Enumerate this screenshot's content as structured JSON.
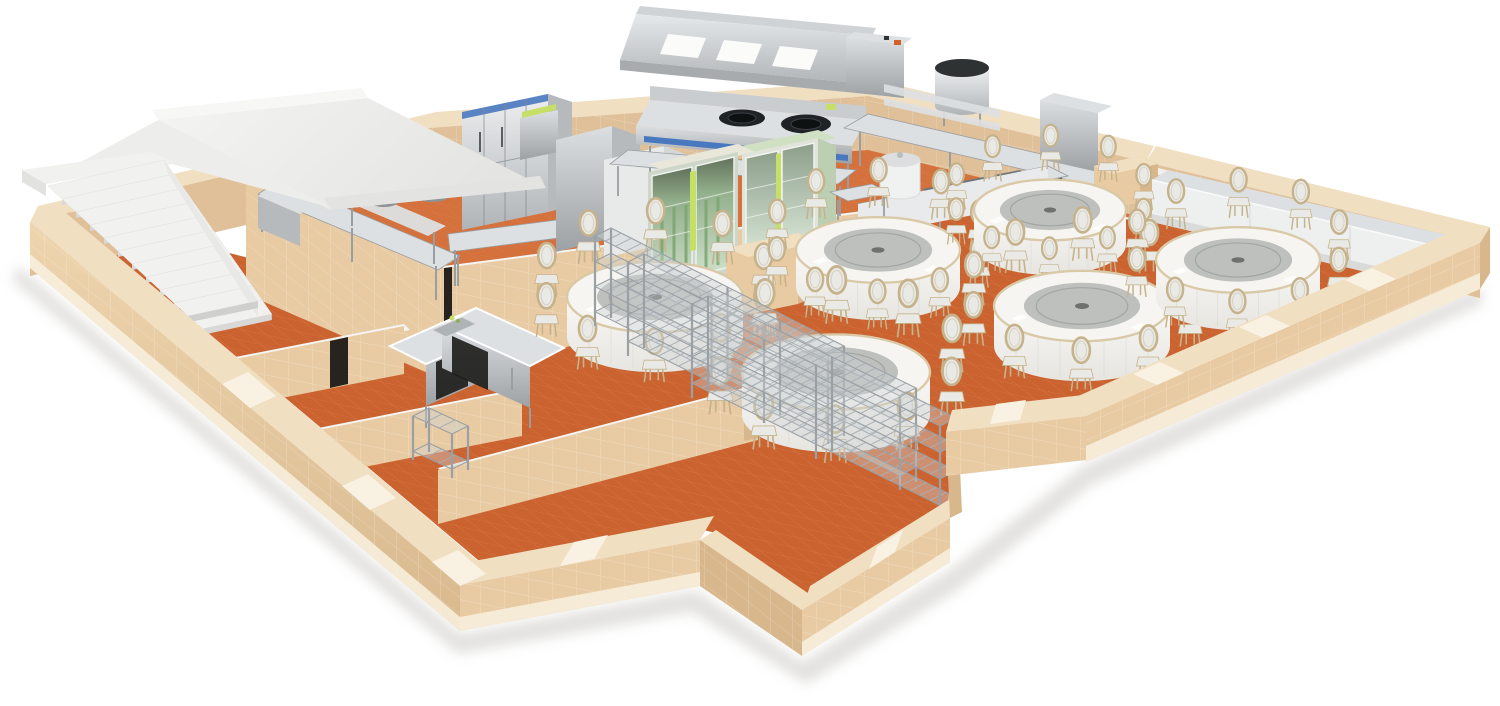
{
  "meta": {
    "alt": "3D cutaway rendering of a banquet restaurant floor plan: commercial kitchen with stainless equipment at the back, round skirted dining tables with oval-back chairs, wire storage racks, white staircase, terracotta tile floors and tan tiled perimeter walls",
    "background": "#ffffff"
  },
  "palette": {
    "floor": "#cb6330",
    "floor_line": "#e18a58",
    "floor_kitchen": "#d4713c",
    "wall_top": "#f1dfc2",
    "wall_face": "#e8cba3",
    "wall_face_dark": "#d8b78c",
    "wall_inner": "#dfc099",
    "plinth": "#f7eedb",
    "door_gap": "#f9f1e2",
    "cap_white": "#f5f5f3",
    "steel": "#b6babd",
    "steel_light": "#dde0e2",
    "steel_dark": "#8e9295",
    "steel_edge": "#989ea2",
    "white": "#f2f2f0",
    "stair_tread": "#f1f1ef",
    "stair_riser": "#d8d8d6",
    "ramp": "#f0f0ee",
    "cloth": "#f4f3f0",
    "table_edge": "#d9c9a7",
    "susan": "#bdc0bd",
    "susan_dark": "#a2a5a3",
    "chair_pad": "#e9eae6",
    "chair_frame": "#c6b28b",
    "glass_green": "#a6c19e",
    "glass_light": "#d5e3d1",
    "accent_green": "#c6df66",
    "accent_sage": "#cfe0c3",
    "accent_blue": "#4a78bf",
    "burner": "#1f2326",
    "dark_slot": "#27231f",
    "shadow": "#c6c4c0"
  },
  "scene": {
    "areas": [
      {
        "name": "commercial-kitchen"
      },
      {
        "name": "dining-hall"
      },
      {
        "name": "service-room"
      },
      {
        "name": "storage-bay"
      },
      {
        "name": "staircase-corridor"
      }
    ],
    "stairs": {
      "steps": 11
    },
    "dining": {
      "chairs_per_table": 10,
      "tables": [
        {
          "cx": 655,
          "cy": 297,
          "rx": 88
        },
        {
          "cx": 878,
          "cy": 250,
          "rx": 82
        },
        {
          "cx": 1050,
          "cy": 210,
          "rx": 76
        },
        {
          "cx": 836,
          "cy": 372,
          "rx": 94
        },
        {
          "cx": 1082,
          "cy": 306,
          "rx": 88
        },
        {
          "cx": 1238,
          "cy": 260,
          "rx": 82
        }
      ]
    },
    "racks": [
      {
        "x1": 595,
        "y1": 322,
        "x2": 828,
        "y2": 440,
        "h": 86,
        "shelves": 4
      },
      {
        "x1": 628,
        "y1": 352,
        "x2": 900,
        "y2": 486,
        "h": 90,
        "shelves": 4
      },
      {
        "x1": 692,
        "y1": 394,
        "x2": 940,
        "y2": 516,
        "h": 90,
        "shelves": 4
      },
      {
        "x1": 413,
        "y1": 456,
        "x2": 452,
        "y2": 474,
        "h": 40,
        "shelves": 2
      }
    ],
    "equipment": [
      "exhaust-hood",
      "wok-range",
      "upright-refrigerator",
      "hood-dishwasher",
      "glass-door-cooler",
      "steam-kettle",
      "prep-shelving",
      "back-counter",
      "soup-urn",
      "buffet-serving-line",
      "rice-cooker",
      "l-shaped-cabinet",
      "wall-counter",
      "service-podium",
      "prep-bench"
    ]
  }
}
